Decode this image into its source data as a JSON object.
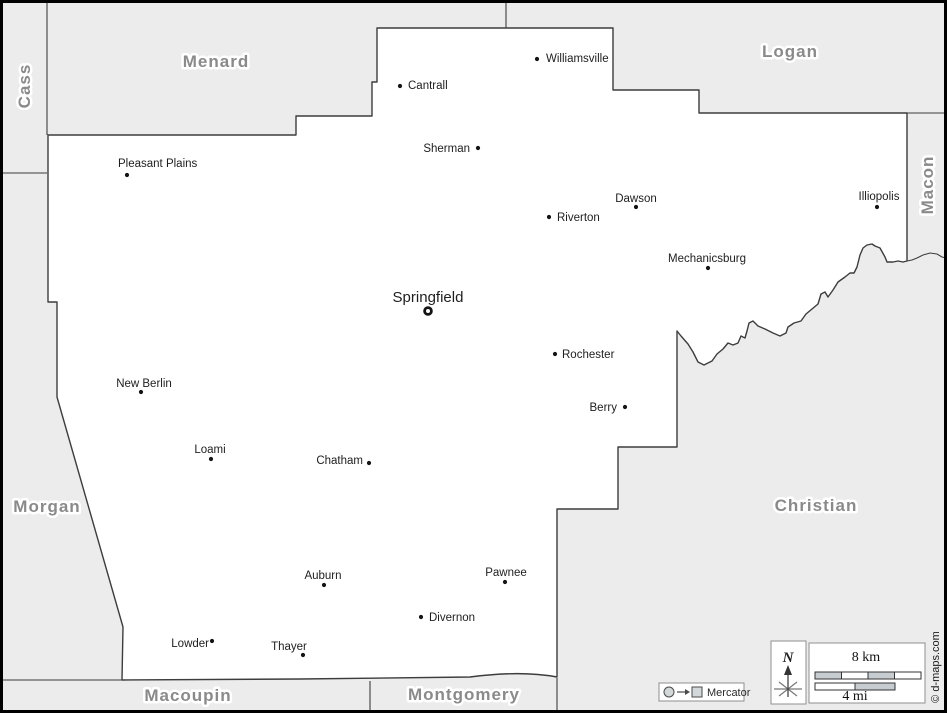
{
  "map": {
    "colors": {
      "outside_fill": "#ececec",
      "county_fill": "#ffffff",
      "border_line": "#3d3d3d",
      "county_label": "#8a8a8a",
      "scale_segment": "#c7ccd0",
      "frame": "#000000"
    },
    "county_labels": [
      {
        "name": "Cass",
        "x": 24,
        "y": 86,
        "rotate": -90
      },
      {
        "name": "Menard",
        "x": 216,
        "y": 61,
        "rotate": 0
      },
      {
        "name": "Logan",
        "x": 790,
        "y": 51,
        "rotate": 0
      },
      {
        "name": "Macon",
        "x": 927,
        "y": 185,
        "rotate": -90
      },
      {
        "name": "Morgan",
        "x": 47,
        "y": 506,
        "rotate": 0
      },
      {
        "name": "Christian",
        "x": 816,
        "y": 505,
        "rotate": 0
      },
      {
        "name": "Macoupin",
        "x": 188,
        "y": 695,
        "rotate": 0
      },
      {
        "name": "Montgomery",
        "x": 464,
        "y": 694,
        "rotate": 0
      }
    ],
    "cities": [
      {
        "name": "Williamsville",
        "x": 537,
        "y": 59,
        "lx": 546,
        "ly": 62,
        "anchor": "start"
      },
      {
        "name": "Cantrall",
        "x": 400,
        "y": 86,
        "lx": 408,
        "ly": 89,
        "anchor": "start"
      },
      {
        "name": "Sherman",
        "x": 478,
        "y": 148,
        "lx": 470,
        "ly": 152,
        "anchor": "end"
      },
      {
        "name": "Pleasant Plains",
        "x": 127,
        "y": 175,
        "lx": 118,
        "ly": 167,
        "anchor": "start"
      },
      {
        "name": "Dawson",
        "x": 636,
        "y": 207,
        "lx": 636,
        "ly": 202,
        "anchor": "middle"
      },
      {
        "name": "Riverton",
        "x": 549,
        "y": 217,
        "lx": 557,
        "ly": 221,
        "anchor": "start"
      },
      {
        "name": "Illiopolis",
        "x": 877,
        "y": 207,
        "lx": 879,
        "ly": 200,
        "anchor": "middle"
      },
      {
        "name": "Mechanicsburg",
        "x": 708,
        "y": 268,
        "lx": 707,
        "ly": 262,
        "anchor": "middle"
      },
      {
        "name": "Springfield",
        "x": 428,
        "y": 311,
        "lx": 428,
        "ly": 302,
        "anchor": "middle",
        "county_seat": true
      },
      {
        "name": "Rochester",
        "x": 555,
        "y": 354,
        "lx": 562,
        "ly": 358,
        "anchor": "start"
      },
      {
        "name": "New Berlin",
        "x": 141,
        "y": 392,
        "lx": 144,
        "ly": 387,
        "anchor": "middle"
      },
      {
        "name": "Berry",
        "x": 625,
        "y": 407,
        "lx": 617,
        "ly": 411,
        "anchor": "end"
      },
      {
        "name": "Loami",
        "x": 211,
        "y": 459,
        "lx": 210,
        "ly": 453,
        "anchor": "middle"
      },
      {
        "name": "Chatham",
        "x": 369,
        "y": 463,
        "lx": 363,
        "ly": 464,
        "anchor": "end"
      },
      {
        "name": "Auburn",
        "x": 324,
        "y": 585,
        "lx": 323,
        "ly": 579,
        "anchor": "middle"
      },
      {
        "name": "Pawnee",
        "x": 505,
        "y": 582,
        "lx": 506,
        "ly": 576,
        "anchor": "middle"
      },
      {
        "name": "Divernon",
        "x": 421,
        "y": 617,
        "lx": 429,
        "ly": 621,
        "anchor": "start"
      },
      {
        "name": "Lowder",
        "x": 212,
        "y": 641,
        "lx": 209,
        "ly": 647,
        "anchor": "end"
      },
      {
        "name": "Thayer",
        "x": 303,
        "y": 655,
        "lx": 289,
        "ly": 650,
        "anchor": "middle"
      }
    ]
  },
  "legend": {
    "projection_label": "Mercator",
    "north_label": "N",
    "scale_km": "8 km",
    "scale_mi": "4 mi",
    "copyright": "© d-maps.com"
  }
}
